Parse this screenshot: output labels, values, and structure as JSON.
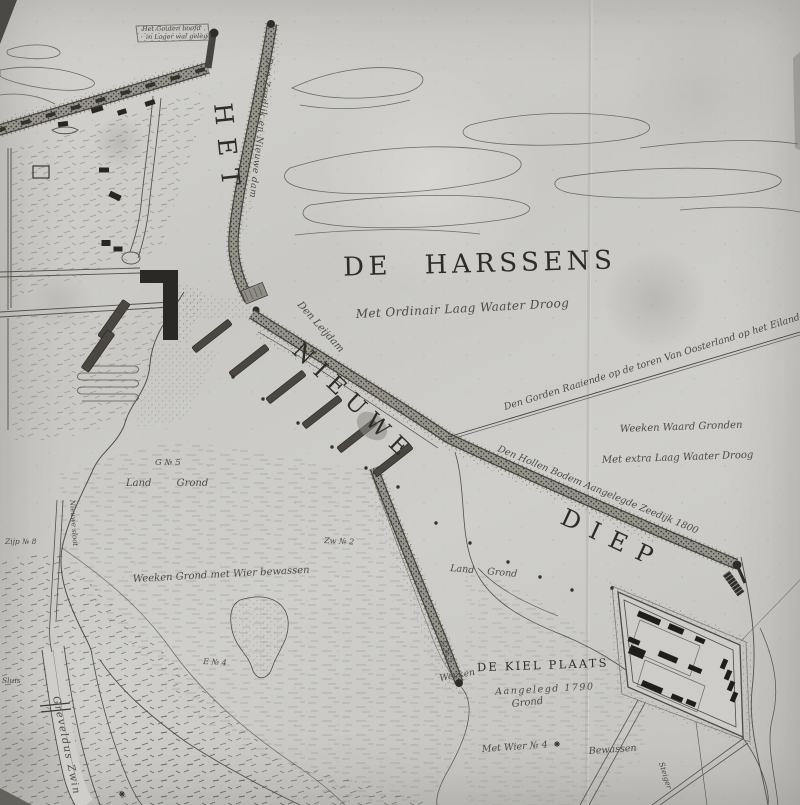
{
  "map": {
    "titles": {
      "het": "HET",
      "nieuwe": "NIEUWE",
      "diep": "DIEP",
      "harssens": "DE HARSSENS",
      "kielplaats": "DE KIEL PLAATS"
    },
    "notes": {
      "harssens": "Met Ordinair Laag Waater Droog",
      "kielplaats": "Aangelegd 1790"
    },
    "annotations": {
      "survey_line": "Den Gorden Raaiende op de toren Van Oosterland op het Eiland",
      "weeken_waard_1": "Weeken Waard Gronden",
      "weeken_waard_2": "Met extra Laag Waater Droog",
      "zeedijk": "Den Hollen Bodem Aangelegde Zeedijk 1800",
      "leijdam": "Den Leijdam",
      "top_dike": "Den Zeedijk en Nieuwe dam",
      "flag_1": "Het Gouten hoofd",
      "flag_2": "in Lager wal gelegd",
      "weeken": "Weeken",
      "grond": "Grond",
      "met_wier": "Met Wier № 4",
      "bewassen": "Bewassen",
      "weeken_grond": "Weeken Grond met Wier bewassen",
      "land_grond_1": "Land Grond",
      "land_grond_2": "Land Grond",
      "greveldus": "Greveldus Zwin",
      "nieuwe_sloot": "Nieuwe sloot",
      "steiger": "Steiger",
      "sluis": "Sluis"
    },
    "markers": {
      "g5": "G № 5",
      "g5_dike": "G № 5",
      "zw2": "Zw № 2",
      "e4": "E № 4",
      "zijp8": "Zijp № 8"
    },
    "colors": {
      "ink": "#2d2c27",
      "script_ink": "#4b4a44",
      "paper": "#cbcac6"
    }
  }
}
